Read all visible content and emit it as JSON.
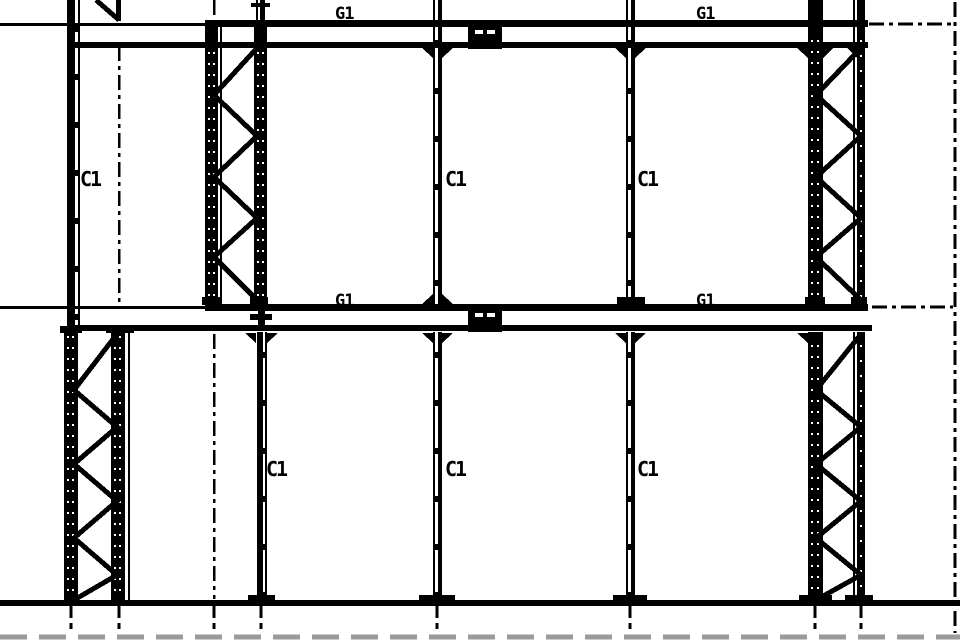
{
  "drawing": {
    "colors": {
      "line": "#000000",
      "background": "#ffffff",
      "break_line": "#9a9a9a"
    },
    "labels": {
      "girders": {
        "top_left": "G1",
        "top_right": "G1",
        "mid_left": "G1",
        "mid_right": "G1"
      },
      "columns": {
        "upper_left": "C1",
        "upper_center": "C1",
        "upper_right": "C1",
        "lower_left": "C1",
        "lower_center": "C1",
        "lower_right": "C1"
      }
    }
  }
}
